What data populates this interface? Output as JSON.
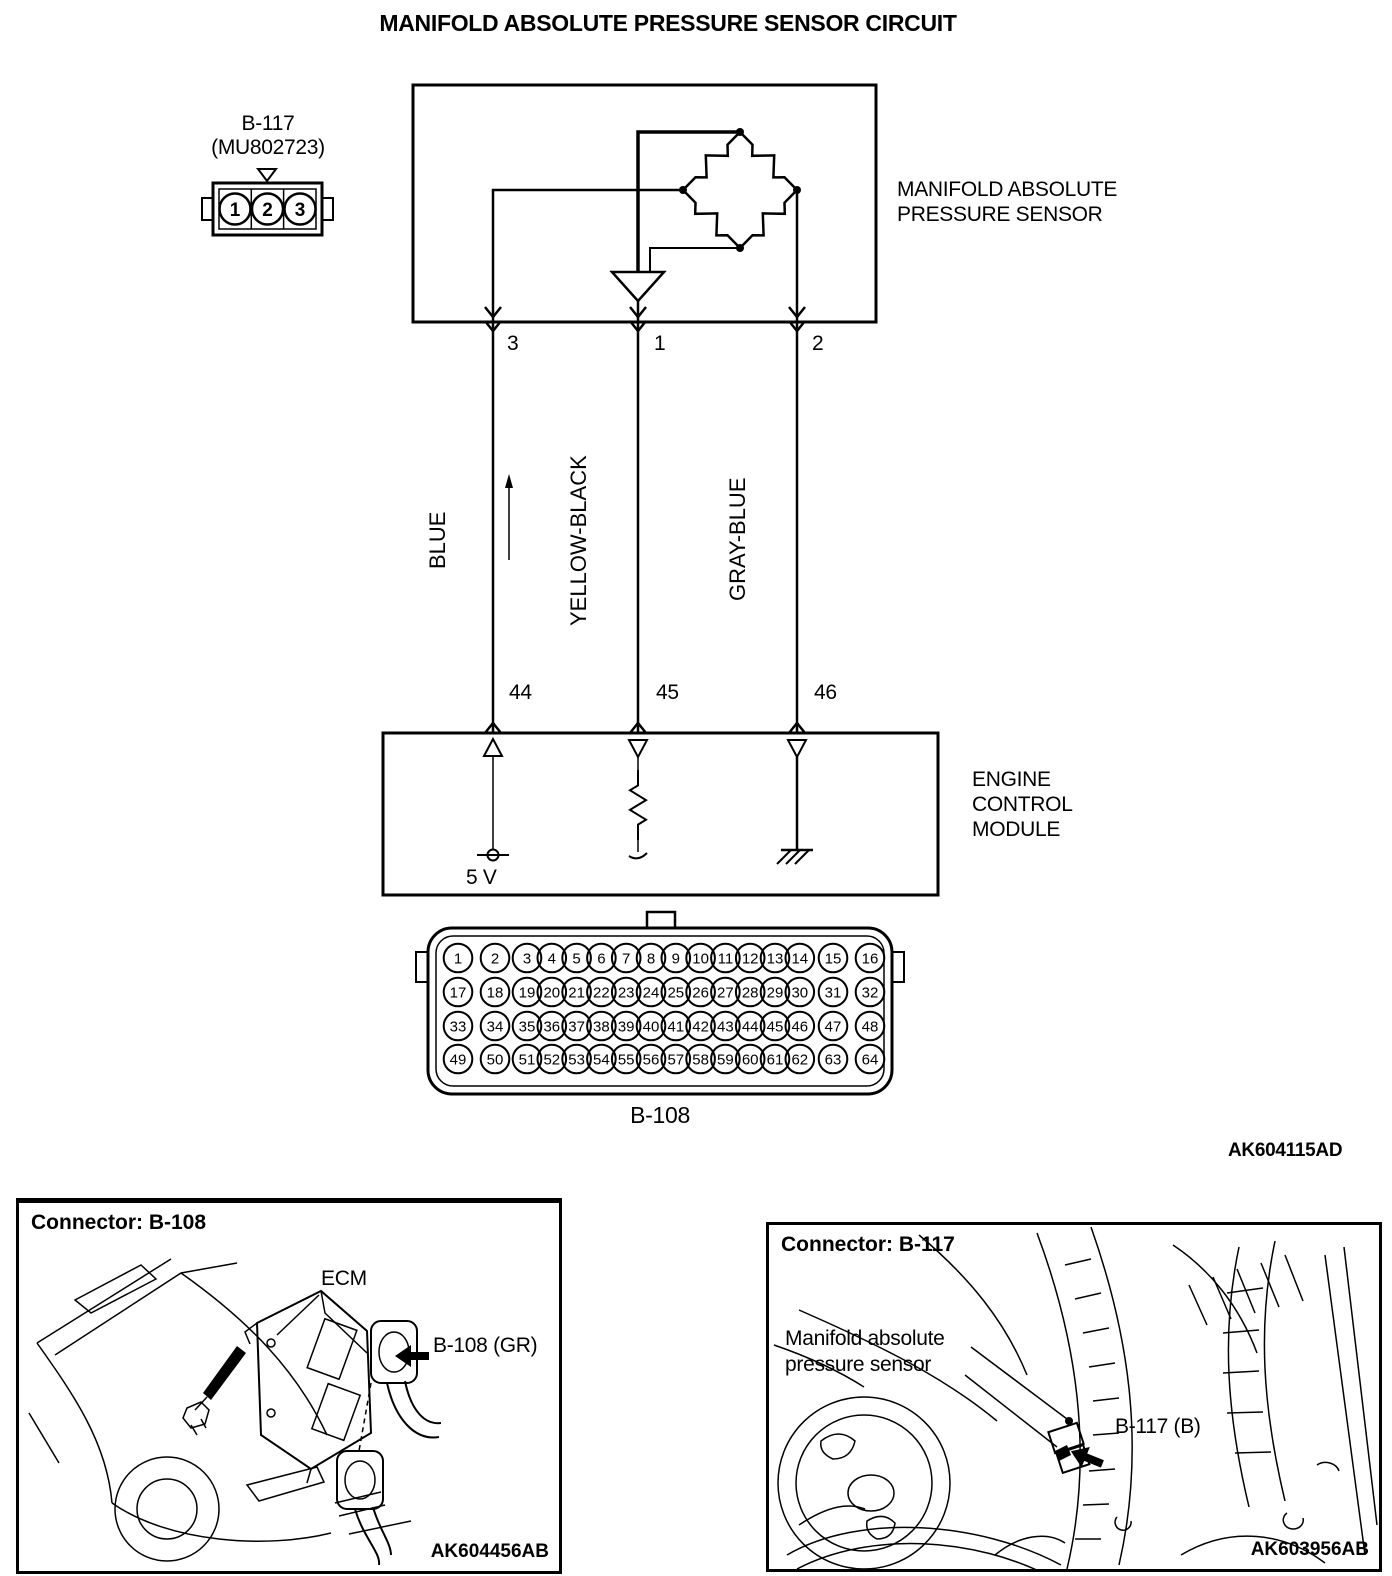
{
  "title": "MANIFOLD ABSOLUTE PRESSURE SENSOR CIRCUIT",
  "doc_code": "AK604115AD",
  "connector_b117": {
    "name": "B-117",
    "part_number": "(MU802723)",
    "pins": [
      "1",
      "2",
      "3"
    ]
  },
  "sensor": {
    "label_line1": "MANIFOLD ABSOLUTE",
    "label_line2": "PRESSURE SENSOR"
  },
  "wires": [
    {
      "pin_top": "3",
      "color": "BLUE",
      "pin_bottom": "44"
    },
    {
      "pin_top": "1",
      "color": "YELLOW-BLACK",
      "pin_bottom": "45"
    },
    {
      "pin_top": "2",
      "color": "GRAY-BLUE",
      "pin_bottom": "46"
    }
  ],
  "ecm": {
    "label_line1": "ENGINE",
    "label_line2": "CONTROL",
    "label_line3": "MODULE",
    "supply": "5 V"
  },
  "connector_b108": {
    "name": "B-108",
    "pin_rows": [
      [
        1,
        2,
        3,
        4,
        5,
        6,
        7,
        8,
        9,
        10,
        11,
        12,
        13,
        14,
        15,
        16
      ],
      [
        17,
        18,
        19,
        20,
        21,
        22,
        23,
        24,
        25,
        26,
        27,
        28,
        29,
        30,
        31,
        32
      ],
      [
        33,
        34,
        35,
        36,
        37,
        38,
        39,
        40,
        41,
        42,
        43,
        44,
        45,
        46,
        47,
        48
      ],
      [
        49,
        50,
        51,
        52,
        53,
        54,
        55,
        56,
        57,
        58,
        59,
        60,
        61,
        62,
        63,
        64
      ]
    ]
  },
  "panel_b108": {
    "heading": "Connector: B-108",
    "ecm_label": "ECM",
    "connector_label": "B-108 (GR)",
    "code": "AK604456AB"
  },
  "panel_b117": {
    "heading": "Connector: B-117",
    "sensor_label_line1": "Manifold absolute",
    "sensor_label_line2": "pressure sensor",
    "connector_label": "B-117 (B)",
    "code": "AK603956AB"
  }
}
